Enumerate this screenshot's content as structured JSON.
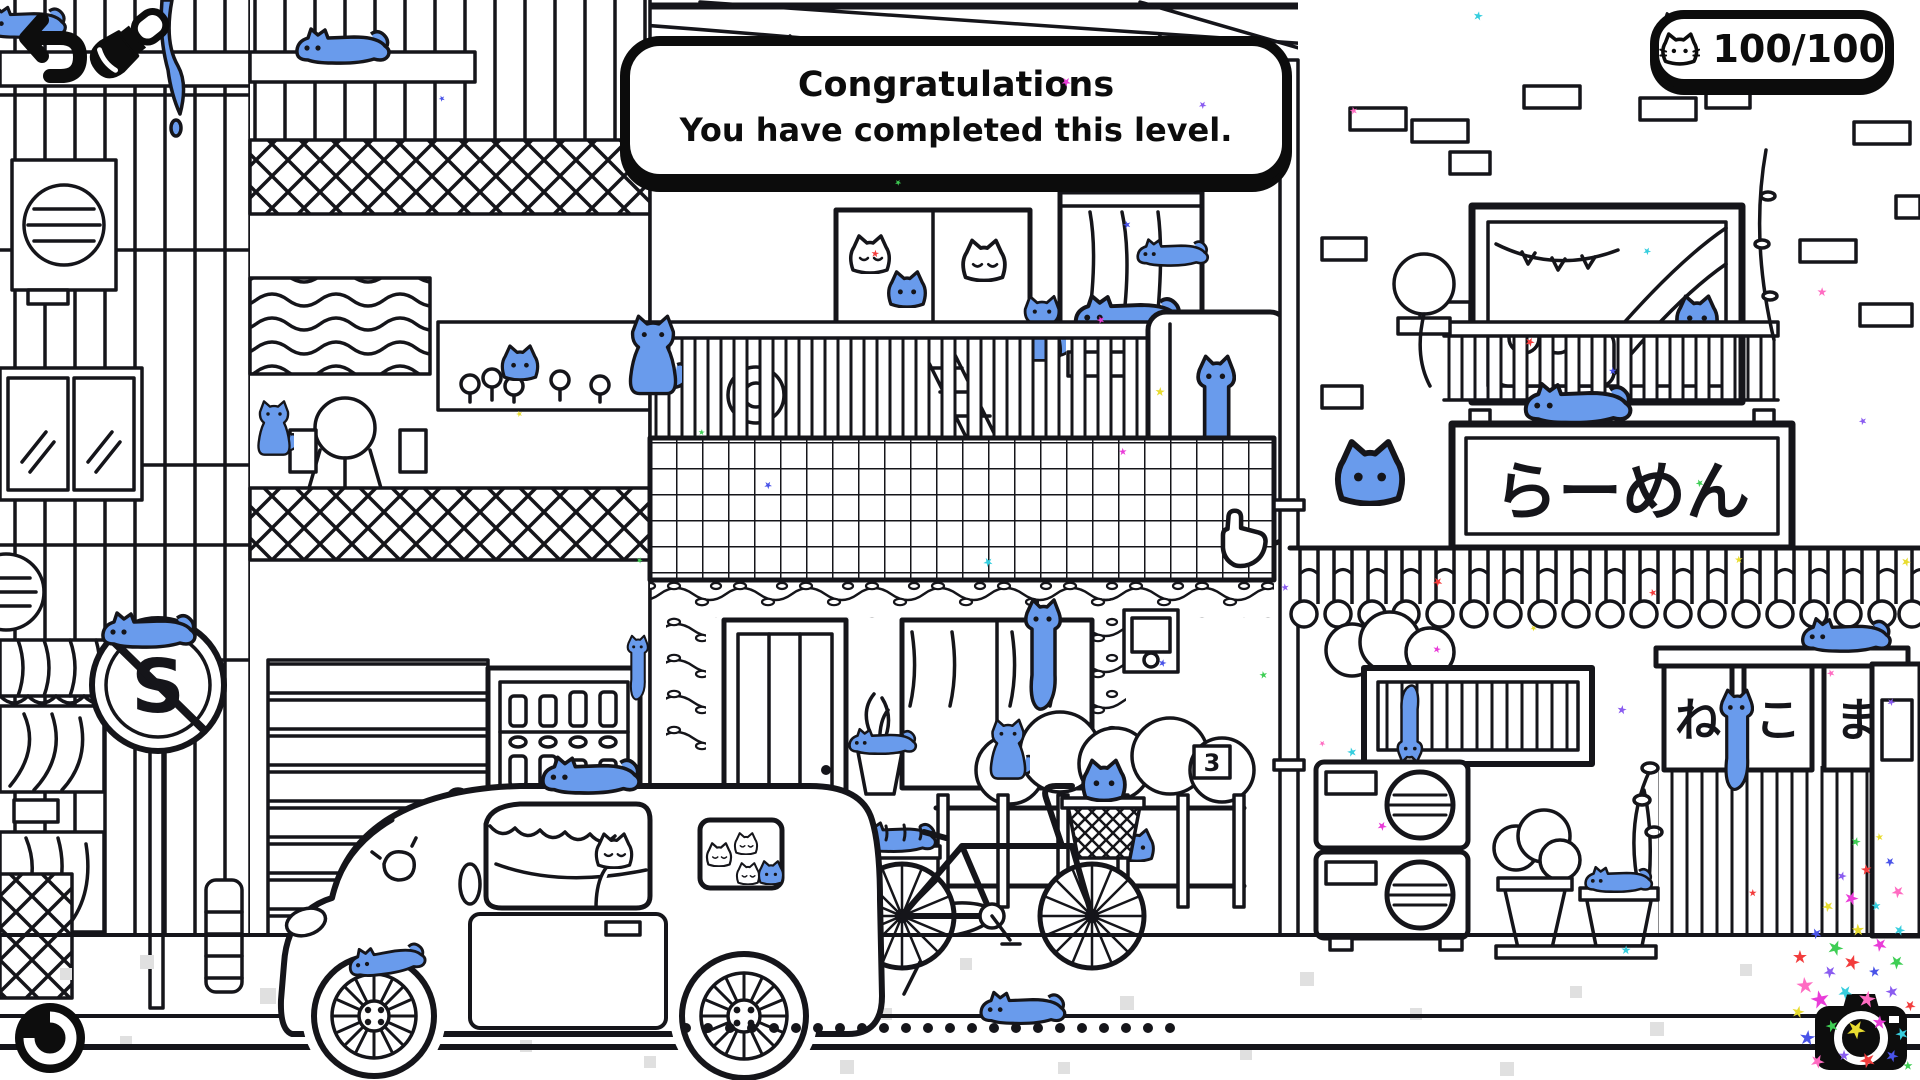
{
  "hud": {
    "banner": {
      "line1": "Congratulations",
      "line2": "You have completed this level."
    },
    "counter": {
      "value": "100/100",
      "icon": "cat-face"
    },
    "buttons": {
      "back": "undo-arrow",
      "brush": "paintbrush",
      "replay": "replay-circle",
      "camera": "camera-with-confetti"
    },
    "cursor": "hand-pointer"
  },
  "scene": {
    "signs": {
      "ramen": "らーめん",
      "noren": [
        "ね",
        "こ",
        "ま"
      ],
      "prohibition_letter": "S",
      "address_number": "3"
    },
    "colors": {
      "ink": "#15151a",
      "cat_blue": "#699bec",
      "paper": "#ffffff",
      "sidewalk_dot": "#e0e0e0"
    }
  },
  "confetti": {
    "palette": [
      "#f23c3c",
      "#4953e8",
      "#3ece54",
      "#e8dc30",
      "#e93cd8",
      "#37cede",
      "#ff6cc2",
      "#8a5cf0"
    ],
    "stars": [
      [
        1800,
        958,
        18,
        0
      ],
      [
        1816,
        934,
        14,
        1
      ],
      [
        1836,
        948,
        20,
        2
      ],
      [
        1858,
        930,
        16,
        3
      ],
      [
        1880,
        944,
        18,
        4
      ],
      [
        1900,
        930,
        14,
        5
      ],
      [
        1806,
        986,
        22,
        6
      ],
      [
        1830,
        972,
        16,
        7
      ],
      [
        1852,
        962,
        20,
        0
      ],
      [
        1874,
        972,
        14,
        1
      ],
      [
        1896,
        962,
        18,
        2
      ],
      [
        1798,
        1012,
        16,
        3
      ],
      [
        1820,
        1000,
        24,
        4
      ],
      [
        1846,
        992,
        18,
        5
      ],
      [
        1868,
        1000,
        22,
        6
      ],
      [
        1892,
        992,
        16,
        7
      ],
      [
        1910,
        1006,
        14,
        0
      ],
      [
        1808,
        1038,
        20,
        1
      ],
      [
        1832,
        1026,
        16,
        2
      ],
      [
        1856,
        1030,
        24,
        3
      ],
      [
        1880,
        1022,
        18,
        4
      ],
      [
        1902,
        1034,
        16,
        5
      ],
      [
        1818,
        1062,
        18,
        6
      ],
      [
        1844,
        1056,
        14,
        7
      ],
      [
        1868,
        1060,
        20,
        0
      ],
      [
        1892,
        1056,
        16,
        1
      ],
      [
        1908,
        1066,
        12,
        2
      ],
      [
        1828,
        906,
        14,
        3
      ],
      [
        1852,
        898,
        18,
        4
      ],
      [
        1876,
        906,
        12,
        5
      ],
      [
        1898,
        892,
        16,
        6
      ],
      [
        1842,
        876,
        12,
        7
      ],
      [
        1866,
        870,
        14,
        0
      ],
      [
        1890,
        862,
        12,
        1
      ],
      [
        1856,
        842,
        12,
        2
      ],
      [
        1880,
        836,
        10,
        3
      ],
      [
        1066,
        82,
        12,
        4
      ],
      [
        1478,
        16,
        12,
        5
      ],
      [
        1354,
        112,
        10,
        6
      ],
      [
        1202,
        106,
        10,
        7
      ],
      [
        874,
        254,
        10,
        0
      ],
      [
        1126,
        224,
        10,
        1
      ],
      [
        898,
        182,
        8,
        2
      ],
      [
        1160,
        392,
        12,
        3
      ],
      [
        1102,
        320,
        10,
        4
      ],
      [
        1648,
        252,
        10,
        5
      ],
      [
        1822,
        292,
        12,
        6
      ],
      [
        1862,
        422,
        10,
        7
      ],
      [
        1530,
        342,
        12,
        0
      ],
      [
        1612,
        370,
        10,
        1
      ],
      [
        1700,
        482,
        10,
        2
      ],
      [
        1906,
        562,
        12,
        3
      ],
      [
        1124,
        452,
        10,
        4
      ],
      [
        988,
        562,
        12,
        5
      ],
      [
        1228,
        560,
        10,
        6
      ],
      [
        1284,
        588,
        10,
        7
      ],
      [
        1438,
        582,
        12,
        0
      ],
      [
        1162,
        662,
        10,
        1
      ],
      [
        1264,
        674,
        10,
        2
      ],
      [
        1534,
        628,
        8,
        3
      ],
      [
        1438,
        650,
        10,
        4
      ],
      [
        1352,
        752,
        12,
        5
      ],
      [
        1322,
        744,
        8,
        6
      ],
      [
        1622,
        710,
        12,
        7
      ],
      [
        1652,
        592,
        10,
        0
      ],
      [
        768,
        484,
        10,
        1
      ],
      [
        702,
        432,
        8,
        2
      ],
      [
        520,
        414,
        8,
        3
      ],
      [
        1382,
        826,
        12,
        4
      ],
      [
        1626,
        950,
        12,
        5
      ],
      [
        1830,
        674,
        10,
        6
      ],
      [
        1890,
        702,
        10,
        7
      ],
      [
        1752,
        892,
        10,
        0
      ],
      [
        442,
        98,
        8,
        1
      ],
      [
        640,
        560,
        8,
        2
      ],
      [
        1740,
        560,
        10,
        3
      ]
    ]
  }
}
